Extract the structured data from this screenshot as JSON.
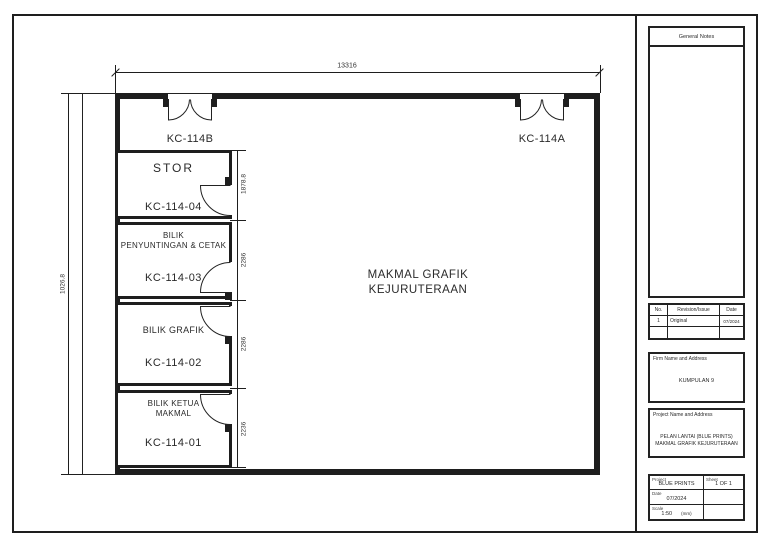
{
  "drawing": {
    "dim_top": "13316",
    "dim_left": "1026.8",
    "hall_label": {
      "line1": "MAKMAL GRAFIK",
      "line2": "KEJURUTERAAN"
    },
    "top_doors": [
      {
        "label": "KC-114B"
      },
      {
        "label": "KC-114A"
      }
    ],
    "rooms": [
      {
        "name1": "STOR",
        "code": "KC-114-04",
        "dim": "1878.8"
      },
      {
        "name1": "BILIK",
        "name2": "PENYUNTINGAN & CETAK",
        "code": "KC-114-03",
        "dim": "2286"
      },
      {
        "name1": "BILIK GRAFIK",
        "code": "KC-114-02",
        "dim": "2286"
      },
      {
        "name1": "BILIK KETUA",
        "name2": "MAKMAL",
        "code": "KC-114-01",
        "dim": "2236"
      }
    ]
  },
  "titleblock": {
    "general_notes_header": "General Notes",
    "revision_table": {
      "col_no": "No.",
      "col_revision": "Revision/Issue",
      "col_date": "Date",
      "row1": {
        "no": "1",
        "revision": "Original",
        "date": "07/2024"
      }
    },
    "firm": {
      "header": "Firm Name and Address",
      "name": "KUMPULAN 9"
    },
    "project": {
      "header": "Project Name and Address",
      "line1": "PELAN LANTAI (BLUE PRINTS)",
      "line2": "MAKMAL GRAFIK KEJURUTERAAN"
    },
    "info": {
      "project_label": "Project",
      "project_value": "BLUE PRINTS",
      "sheet_label": "Sheet",
      "sheet_value": "1 OF 1",
      "date_label": "Date",
      "date_value": "07/2024",
      "scale_label": "Scale",
      "scale_value": "1:50",
      "scale_unit": "(mm)"
    }
  }
}
